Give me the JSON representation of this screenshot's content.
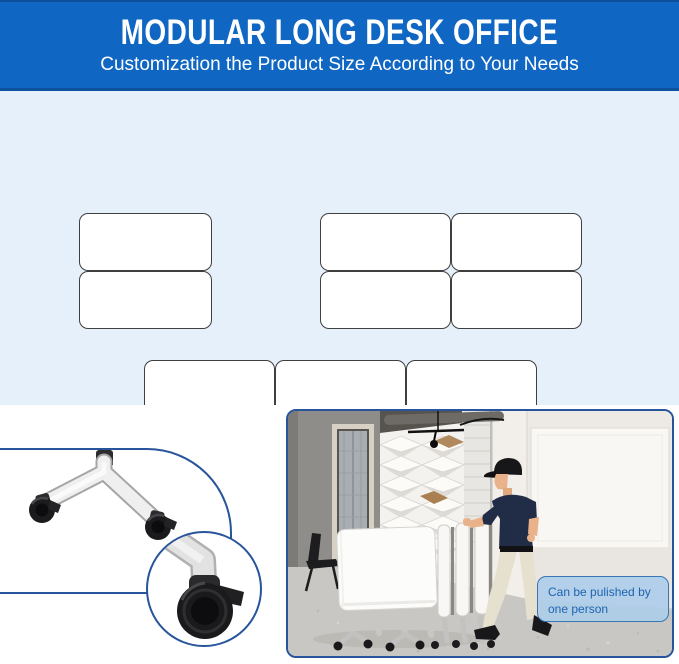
{
  "header": {
    "title": "MODULAR LONG DESK OFFICE",
    "subtitle": "Customization the Product Size According to Your Needs",
    "background": "#0f67c3",
    "edge_line": "#0d519f",
    "text_color": "#ffffff"
  },
  "size_diagram": {
    "background": "#e6f0fb",
    "desk_fill": "#ffffff",
    "desk_outline": "#3f3f3f",
    "groups": [
      {
        "name": "two-desks-stacked",
        "rows": 2,
        "cols": 1,
        "desks": 2
      },
      {
        "name": "four-desks-grid",
        "rows": 2,
        "cols": 2,
        "desks": 4
      },
      {
        "name": "six-desks-grid",
        "rows": 2,
        "cols": 3,
        "desks": 6
      }
    ]
  },
  "caster_detail": {
    "panel_border": "#27549b",
    "shows": [
      "desk-leg-with-two-casters",
      "caster-wheel-closeup-with-brake"
    ]
  },
  "photo": {
    "border": "#27549b",
    "description": "person pushing a row of folded flip-top desks through an office",
    "caption": {
      "text": "Can be pulished by one person",
      "text_color": "#1d64b2",
      "background": "#aecde9",
      "border": "#3877b5"
    }
  }
}
